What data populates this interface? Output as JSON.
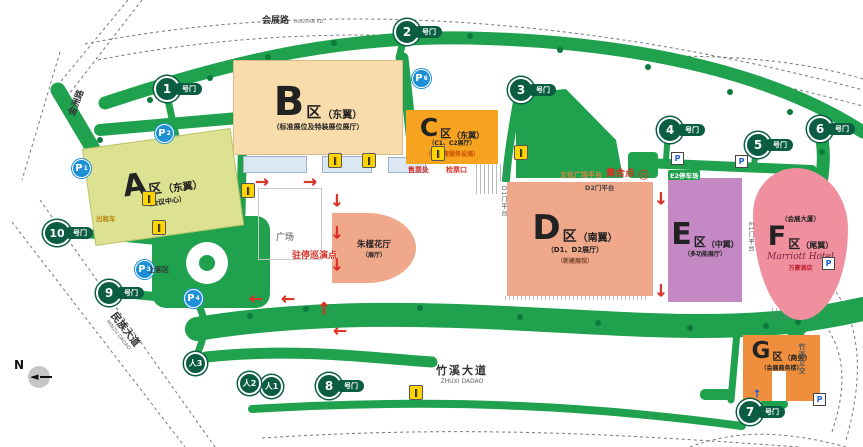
{
  "colors": {
    "road_green": "#1FA14E",
    "gate_green": "#0A5C43",
    "zone_a": "#DCE292",
    "zone_b": "#F8DCAB",
    "zone_c": "#F6A41F",
    "zone_d": "#F0A88B",
    "zone_e": "#C489C4",
    "zone_f": "#F0909F",
    "zone_g": "#EF8F3E",
    "parking_blue": "#1E90D6",
    "accent_red": "#D93025"
  },
  "roads": {
    "huizhan": {
      "zh": "会展路",
      "en": "HUIZHAN RD"
    },
    "jinzhou": {
      "zh": "金洲路"
    },
    "minzu": {
      "zh": "民族大道",
      "en": "MINZU DADAO"
    },
    "zhuxi": {
      "zh": "竹溪大道",
      "en": "ZHUXI DADAO"
    },
    "zhuxi_ramp": {
      "zh": "竹溪立交"
    }
  },
  "zones": [
    {
      "letter": "A",
      "unit": "区",
      "wing": "（东翼）",
      "sub": "（会议中心）"
    },
    {
      "letter": "B",
      "unit": "区",
      "wing": "（东翼）",
      "sub": "（标准展位及特装展位展厅）"
    },
    {
      "letter": "C",
      "unit": "区",
      "wing": "（东翼）",
      "sub": "（C1、C2展厅）",
      "sub2": "（含配套服务设施）"
    },
    {
      "letter": "D",
      "unit": "区",
      "wing": "（南翼）",
      "sub": "（D1、D2展厅）",
      "sub2": "（新建展馆）"
    },
    {
      "letter": "E",
      "unit": "区",
      "wing": "（中翼）",
      "sub": "（多功能展厅）"
    },
    {
      "letter": "F",
      "unit": "区",
      "wing": "（尾翼）",
      "top": "（会展大厦）",
      "script": "Marriott Hotel",
      "sub": "万豪酒店"
    },
    {
      "letter": "G",
      "unit": "区",
      "wing": "（商务）",
      "sub": "（会展商务楼）"
    }
  ],
  "gates": {
    "suffix": "号门",
    "nums": [
      "1",
      "2",
      "3",
      "4",
      "5",
      "6",
      "7",
      "8",
      "9",
      "10"
    ],
    "ped_prefix": "人",
    "ped_nums": [
      "1",
      "2",
      "3"
    ]
  },
  "parking": {
    "letter": "P",
    "circle_subs": [
      "1",
      "2",
      "6",
      "3",
      "4"
    ]
  },
  "icons": {
    "turnstile": "‖",
    "compass_arrow": "◄",
    "assembly_target": "◎"
  },
  "poi": {
    "zhujin": "朱槿花厅",
    "zhujin_sub": "（展厅）",
    "plaza": "广场",
    "boarding": "上客区",
    "taxi": "出租车",
    "parade": "驻停巡演点",
    "assembly": "集合点",
    "culture_platform": "文化广场平台",
    "d2_platform": "D2门平台",
    "e2_parking": "E2停车场",
    "ticket_office": "售票处",
    "ticket_check": "检票口",
    "d1_platform": "D1门平台",
    "e1_platform": "E1门平台",
    "compass_n": "N"
  },
  "arrows": {
    "right": "→",
    "down": "↓",
    "up": "↑",
    "left": "←",
    "blue_up": "↑"
  }
}
